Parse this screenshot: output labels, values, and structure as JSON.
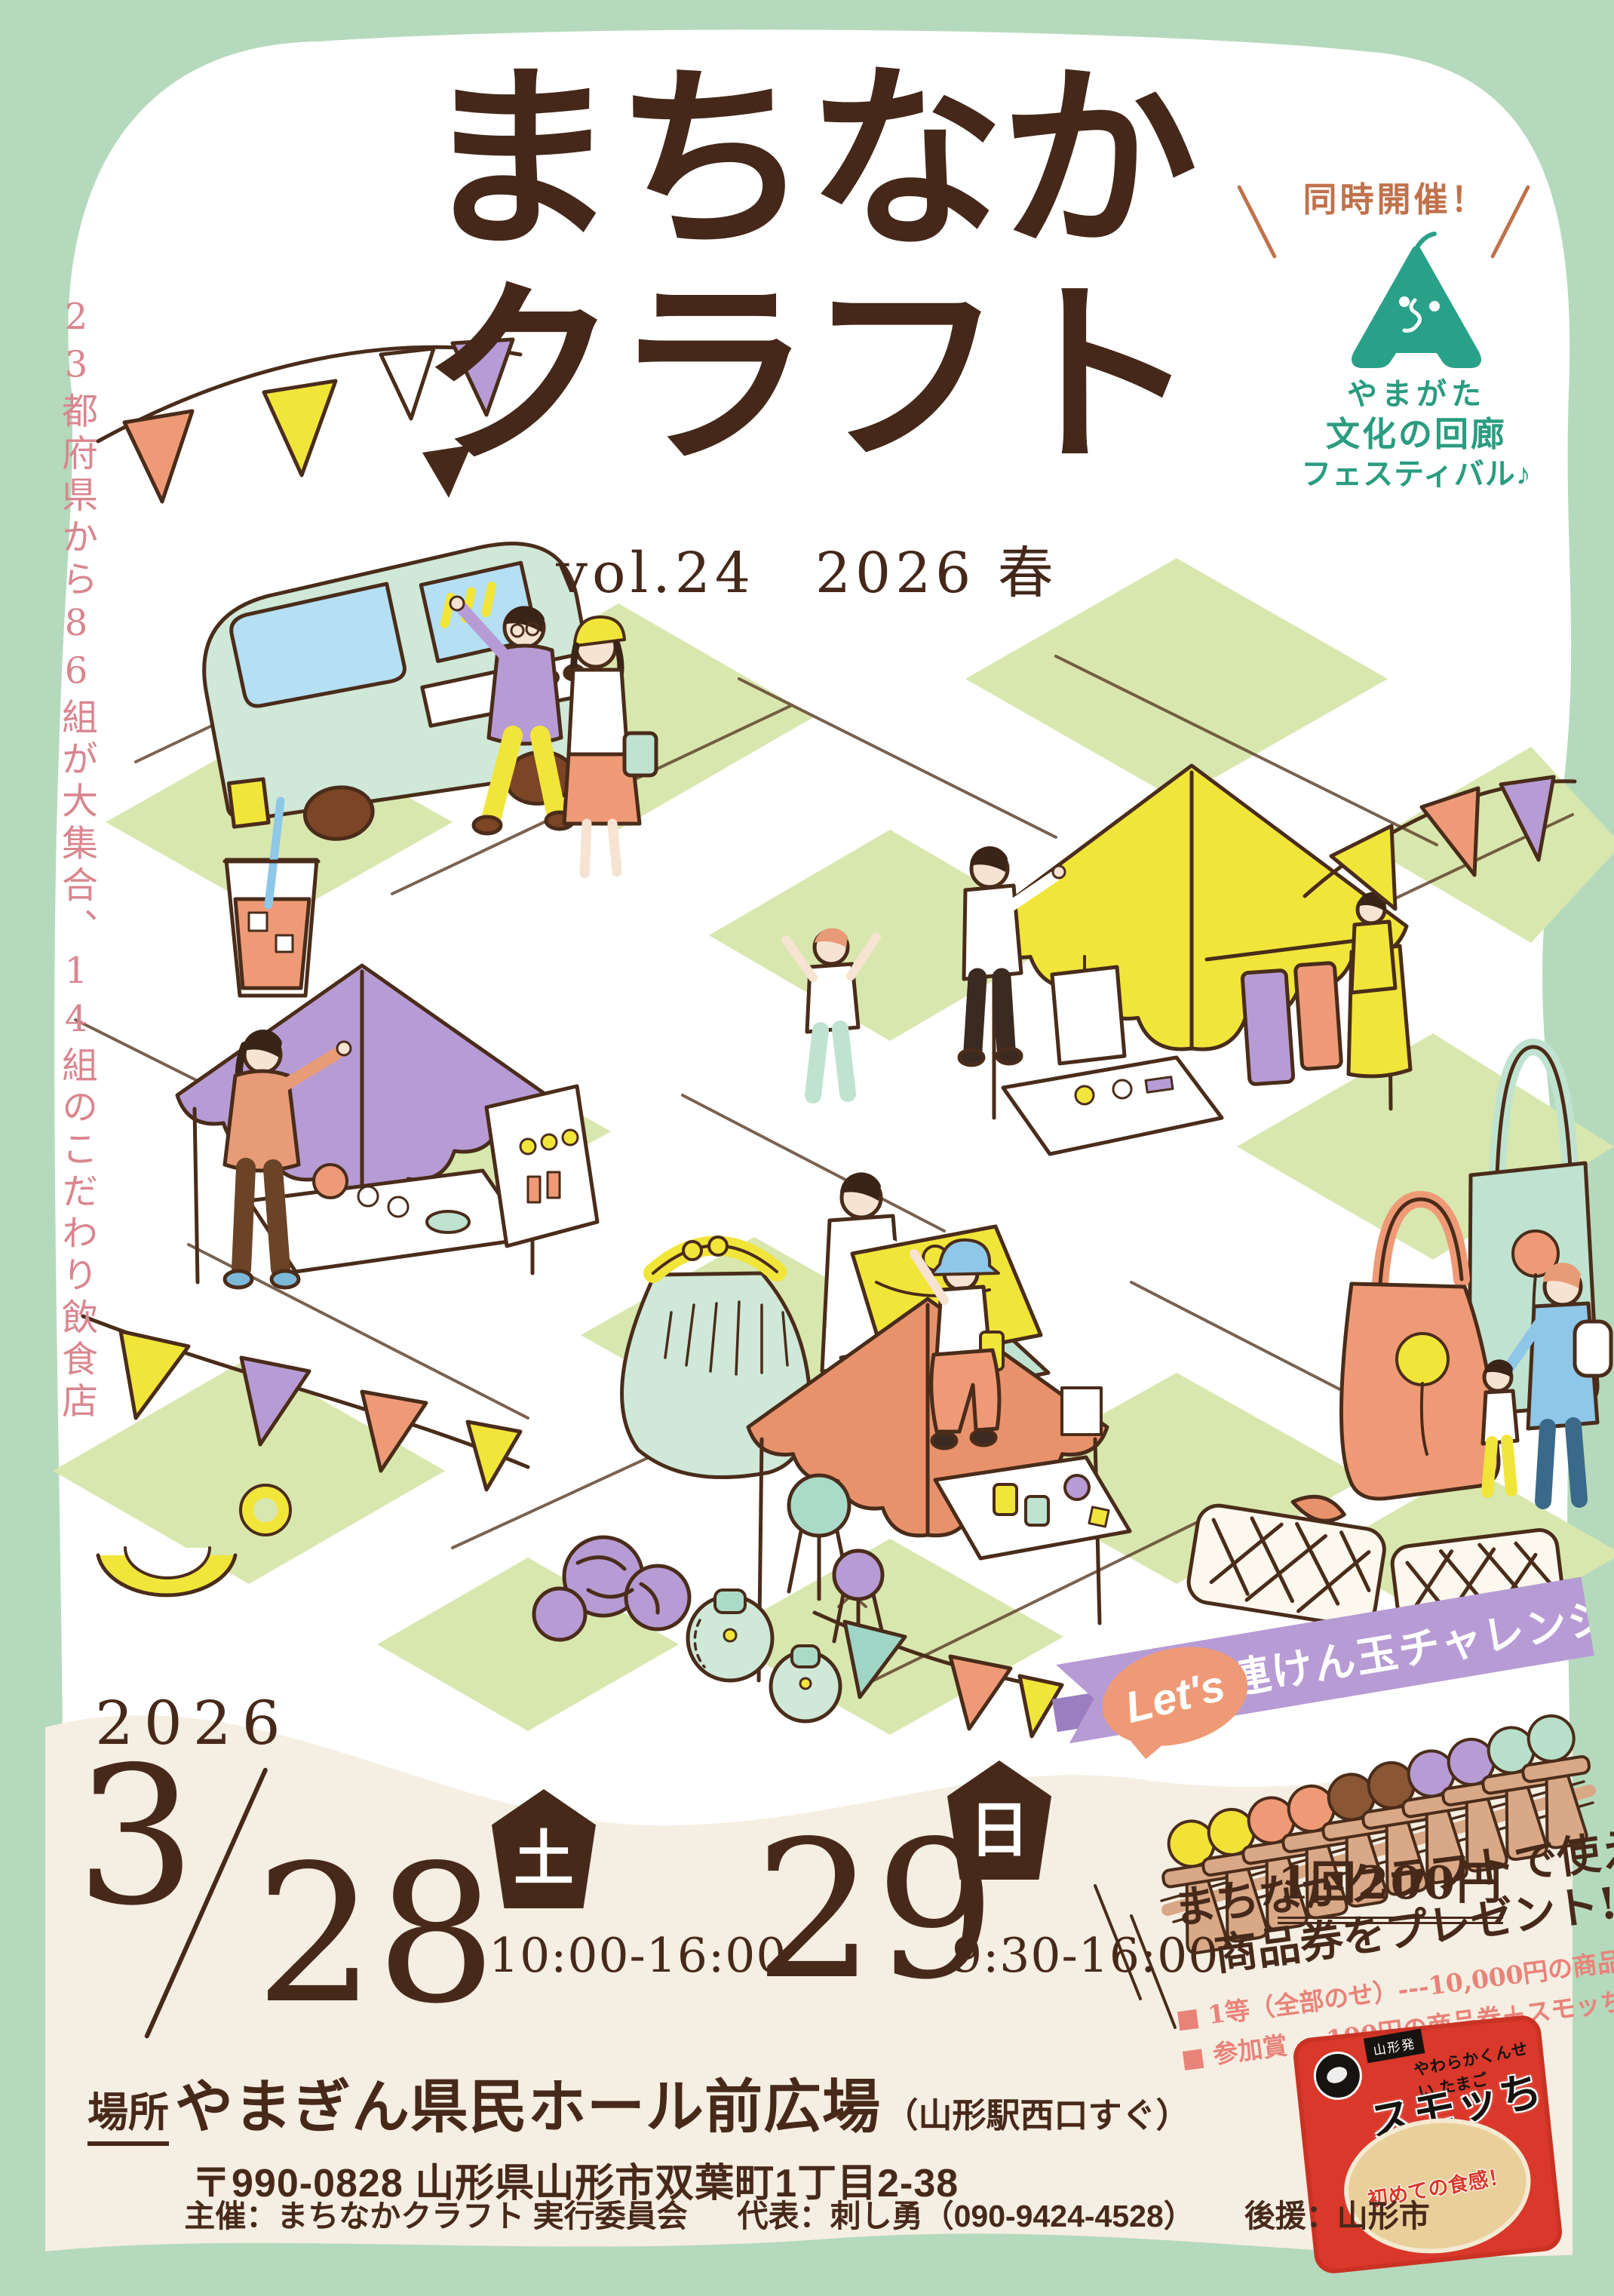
{
  "title": {
    "line1": "まちなか",
    "line2": "クラフト",
    "subtitle": "vol.24　2026 春"
  },
  "side_note": "23都府県から86組が大集合、14組のこだわり飲食店",
  "co_event": {
    "label": "同時開催！",
    "org_line1": "やまがた",
    "org_line2": "文化の回廊",
    "org_line3": "フェスティバル♪"
  },
  "schedule": {
    "year": "2026",
    "month_day1": "3",
    "day1": "28",
    "weekday1": "土",
    "time1": "10:00-16:00",
    "day2": "29",
    "weekday2": "日",
    "time2": "9:30-16:00"
  },
  "kendama": {
    "lets": "Let's",
    "banner": "10連けん玉チャレンジ!!",
    "price": "1回200円",
    "gift_line1": "まちなかクラフトで使える",
    "gift_line2": "商品券をプレゼント!!",
    "detail1": "■ 1等（全部のせ）---10,000円の商品券",
    "detail2": "■ 参加賞 ---100円の商品券＋スモッち1個",
    "ball_colors": [
      "#f2e236",
      "#f2e236",
      "#ef9a76",
      "#ef9a76",
      "#8a5634",
      "#8a5634",
      "#b79bd4",
      "#b79bd4",
      "#b8dfc9",
      "#b8dfc9"
    ]
  },
  "venue": {
    "label": "場所",
    "name": "やまぎん県民ホール前広場",
    "note": "（山形駅西口すぐ）",
    "address": "〒990-0828 山形県山形市双葉町1丁目2-38"
  },
  "footer": {
    "organizer": "主催：まちなかクラフト 実行委員会",
    "representative": "代表：刺し勇（090-9424-4528）",
    "support": "後援：山形市"
  },
  "product": {
    "origin": "山形発",
    "desc": "やわらかくんせい たまご",
    "name": "スモッち",
    "slogan": "初めての食感！"
  },
  "colors": {
    "border_green": "#b5d9bc",
    "cream": "#f5eee2",
    "checker_green": "#d8e7ae",
    "line_brown": "#4a2c1a",
    "text_brown": "#47291a",
    "pink": "#d9868f",
    "badge_salmon": "#c0724c",
    "teal": "#2a9c80",
    "purple": "#b79bd4",
    "yellow": "#f1e53a",
    "salmon": "#ef9a76",
    "mint": "#cfe8d8",
    "tan": "#d9a886"
  }
}
